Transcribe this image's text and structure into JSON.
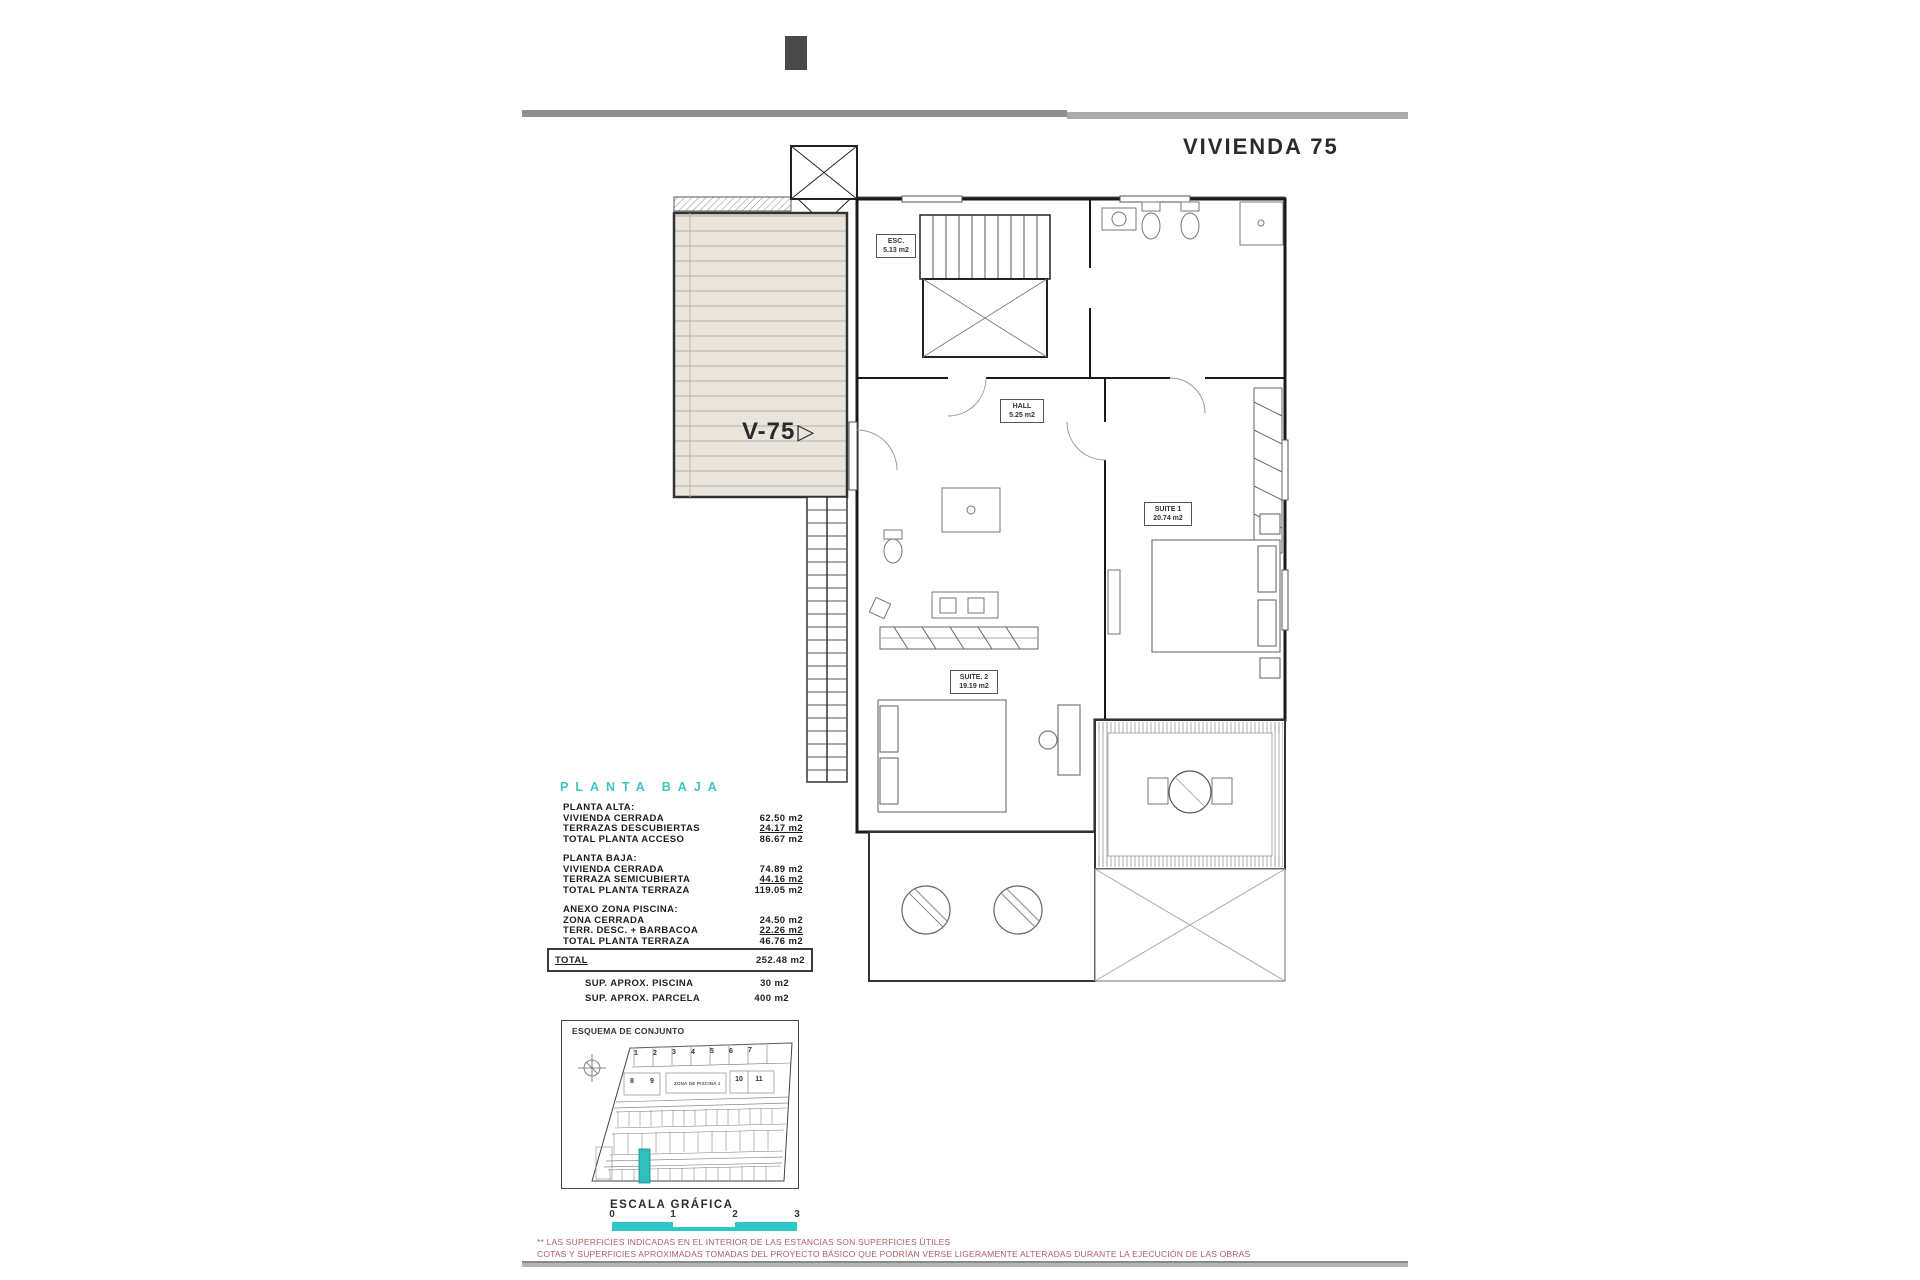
{
  "page": {
    "title": "VIVIENDA 75"
  },
  "plan_labels": {
    "esc": {
      "name": "ESC.",
      "area": "5.13 m2"
    },
    "hall": {
      "name": "HALL",
      "area": "5.25 m2"
    },
    "suite1": {
      "name": "SUITE 1",
      "area": "20.74 m2"
    },
    "suite2": {
      "name": "SUITE. 2",
      "area": "19.19 m2"
    },
    "unit": "V-75",
    "unit_arrow": "▷"
  },
  "area_table": {
    "heading": "PLANTA BAJA",
    "groups": [
      {
        "title": "PLANTA ALTA:",
        "rows": [
          {
            "label": "VIVIENDA CERRADA",
            "value": "62.50 m2"
          },
          {
            "label": "TERRAZAS DESCUBIERTAS",
            "value": "24.17 m2"
          },
          {
            "label": "TOTAL PLANTA ACCESO",
            "value": "86.67 m2"
          }
        ]
      },
      {
        "title": "PLANTA BAJA:",
        "rows": [
          {
            "label": "VIVIENDA CERRADA",
            "value": "74.89 m2"
          },
          {
            "label": "TERRAZA SEMICUBIERTA",
            "value": "44.16 m2"
          },
          {
            "label": "TOTAL PLANTA TERRAZA",
            "value": "119.05 m2"
          }
        ]
      },
      {
        "title": "ANEXO ZONA PISCINA:",
        "rows": [
          {
            "label": "ZONA CERRADA",
            "value": "24.50 m2"
          },
          {
            "label": "TERR. DESC. + BARBACOA",
            "value": "22.26 m2"
          },
          {
            "label": "TOTAL PLANTA TERRAZA",
            "value": "46.76 m2"
          }
        ]
      }
    ],
    "total": {
      "label": "TOTAL",
      "value": "252.48 m2"
    },
    "extras": [
      {
        "label": "SUP.  APROX. PISCINA",
        "value": "30 m2"
      },
      {
        "label": "SUP.  APROX. PARCELA",
        "value": "400 m2"
      }
    ]
  },
  "site_plan": {
    "title": "ESQUEMA DE CONJUNTO",
    "row1_units": [
      "1",
      "2",
      "3",
      "4",
      "5",
      "6",
      "7"
    ],
    "row2_left_units": [
      "8",
      "9"
    ],
    "zone_label": "ZONA DE PISCINA 1",
    "row2_right_units": [
      "10",
      "11"
    ]
  },
  "scale_bar": {
    "title": "ESCALA GRÁFICA",
    "ticks": [
      "0",
      "1",
      "2",
      "3"
    ]
  },
  "footnotes": [
    "** LAS SUPERFICIES INDICADAS EN EL INTERIOR DE LAS ESTANCIAS SON SUPERFICIES ÚTILES",
    "COTAS Y SUPERFICIES APROXIMADAS TOMADAS DEL PROYECTO BÁSICO QUE PODRÍAN VERSE LIGERAMENTE ALTERADAS DURANTE LA EJECUCIÓN DE LAS OBRAS"
  ],
  "colors": {
    "accent_teal": "#2ec6c6",
    "footnote_red": "#ad5f5f",
    "bar_gray": "#9a9a9a"
  }
}
